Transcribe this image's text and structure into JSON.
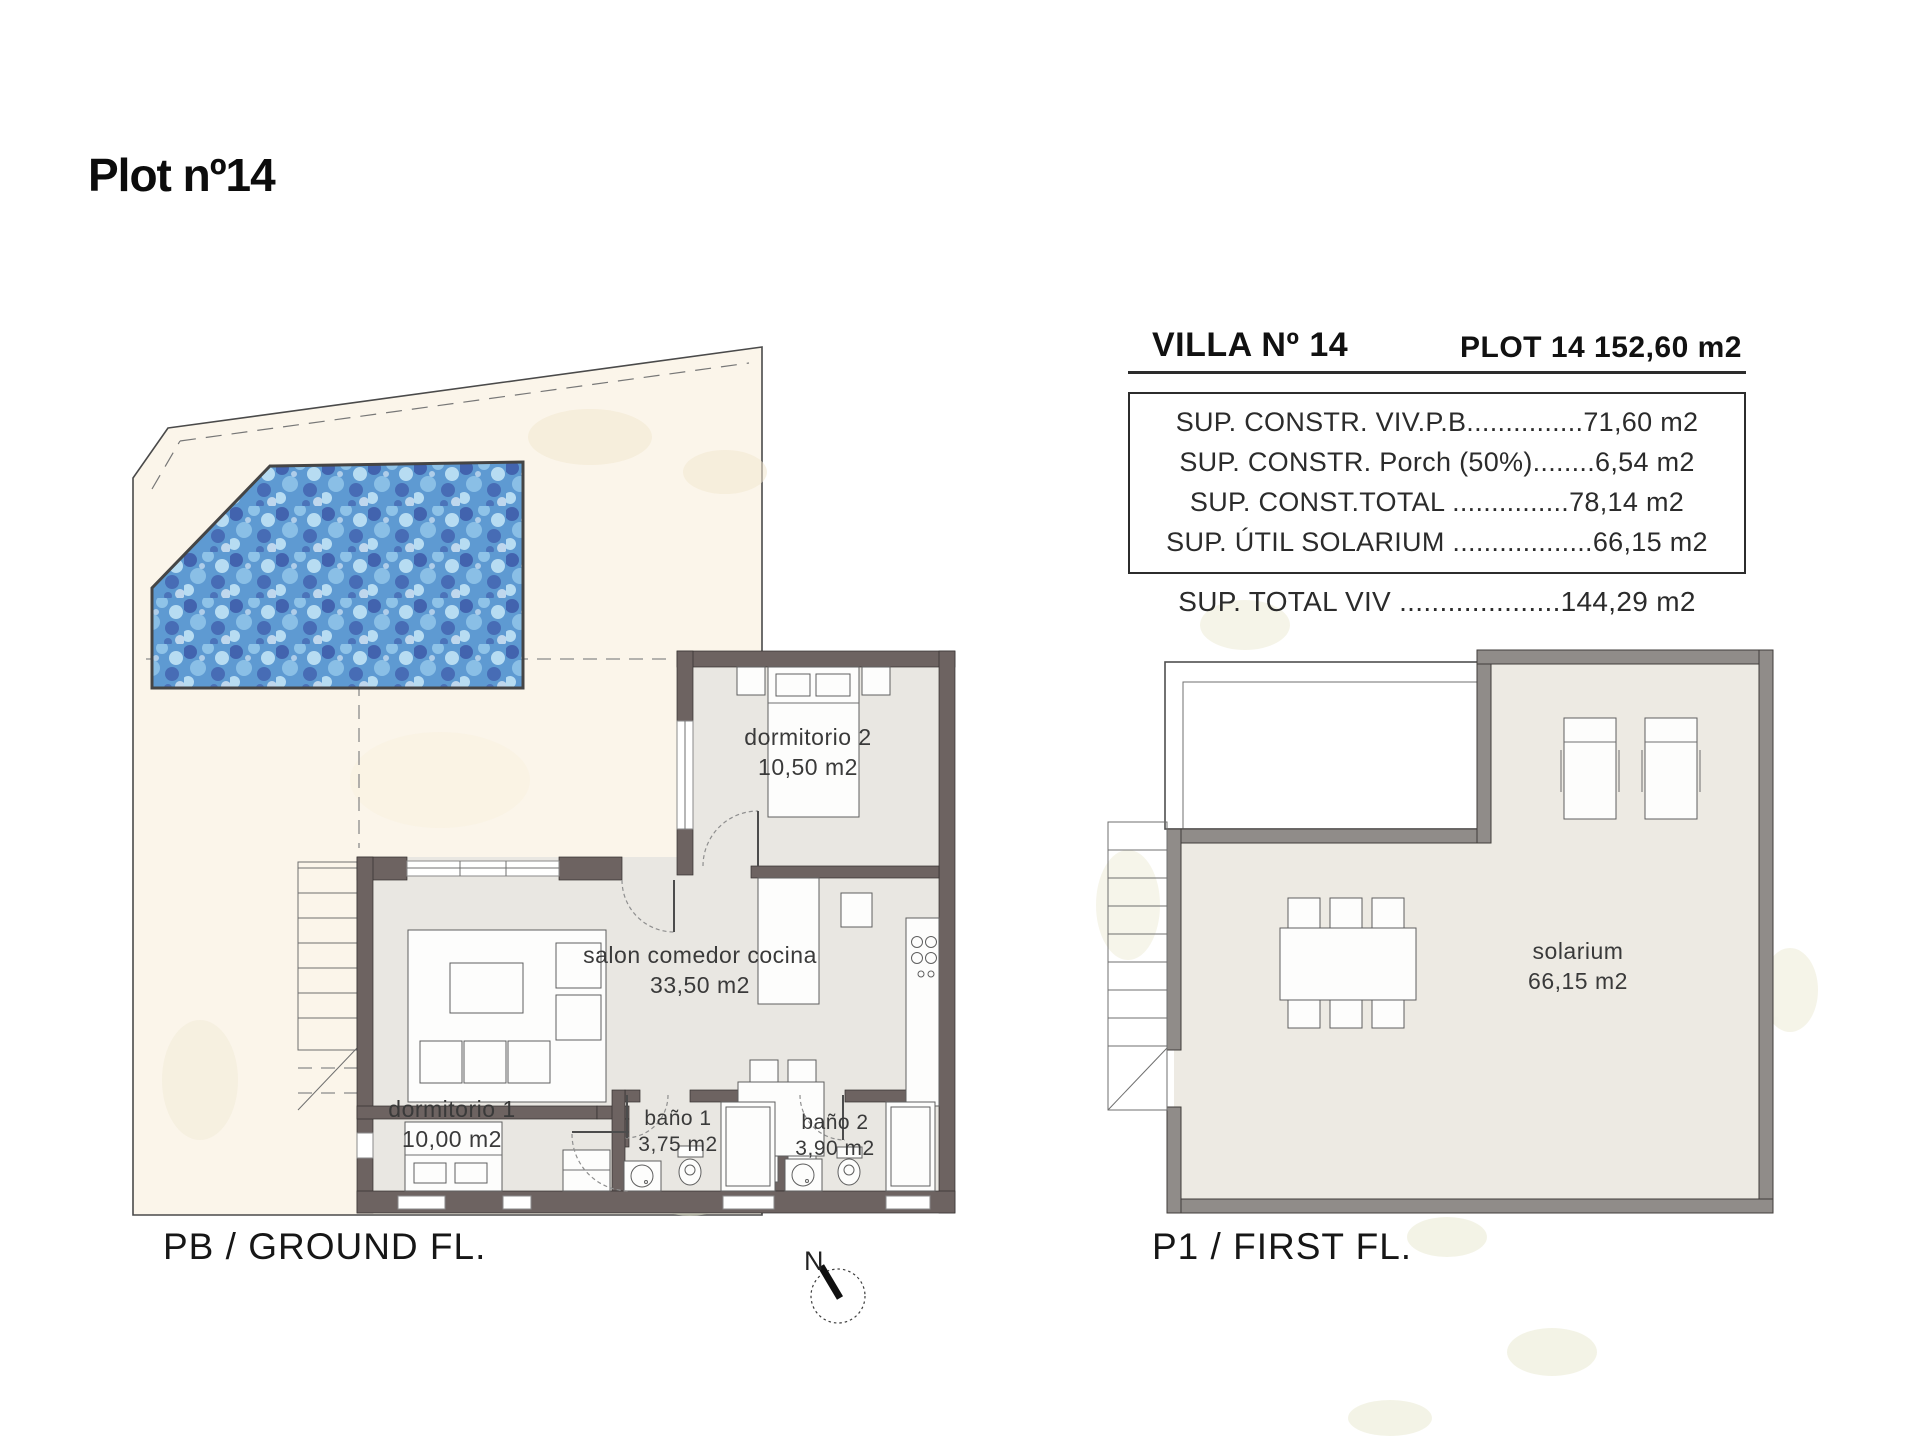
{
  "title": "Plot nº14",
  "info_panel": {
    "villa_title": "VILLA Nº 14",
    "plot_title": "PLOT 14 152,60 m2",
    "rows": [
      "SUP. CONSTR. VIV.P.B...............71,60 m2",
      "SUP. CONSTR. Porch (50%)........6,54 m2",
      "SUP. CONST.TOTAL ...............78,14 m2",
      "SUP. ÚTIL SOLARIUM ..................66,15 m2"
    ],
    "total_row": "SUP. TOTAL VIV ....................144,29 m2"
  },
  "ground_floor": {
    "caption": "PB / GROUND FL.",
    "rooms": [
      {
        "name": "dormitorio 2",
        "area": "10,50 m2"
      },
      {
        "name": "salon comedor cocina",
        "area": "33,50 m2"
      },
      {
        "name": "dormitorio 1",
        "area": "10,00 m2"
      },
      {
        "name": "baño 1",
        "area": "3,75 m2"
      },
      {
        "name": "baño 2",
        "area": "3,90 m2"
      }
    ]
  },
  "first_floor": {
    "caption": "P1 / FIRST FL.",
    "rooms": [
      {
        "name": "solarium",
        "area": "66,15 m2"
      }
    ]
  },
  "compass": {
    "label": "N"
  },
  "colors": {
    "site": "#fbf5ea",
    "floor": "#e9e7e2",
    "floor2": "#edeae3",
    "wall": "#6d6361",
    "fwall": "#908c89",
    "pool1": "#5e9ad2",
    "pool2": "#3d59a8",
    "pool3": "#8fc3e8",
    "pool4": "#b7dcf2"
  }
}
